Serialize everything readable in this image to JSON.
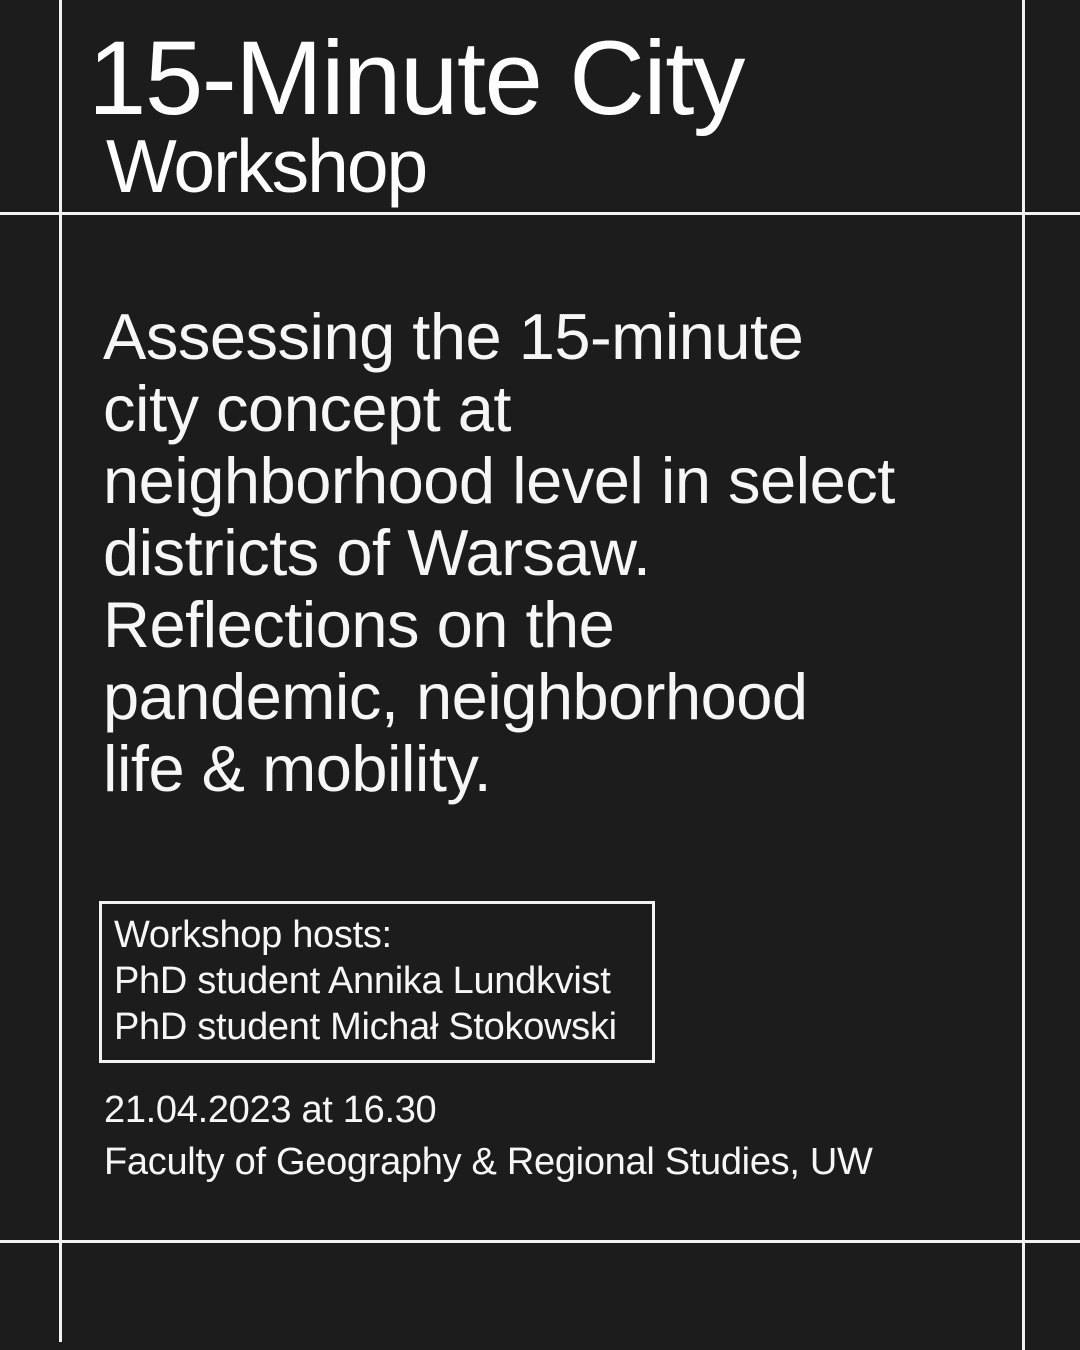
{
  "poster": {
    "title": "15-Minute City",
    "subtitle": "Workshop",
    "description": "Assessing the 15-minute\ncity concept at\nneighborhood level in select\ndistricts of Warsaw.\nReflections on the\npandemic, neighborhood\nlife & mobility.",
    "hosts_box": {
      "heading": "Workshop hosts:",
      "hosts": [
        "PhD student Annika Lundkvist",
        "PhD student Michał Stokowski"
      ]
    },
    "event": {
      "datetime": "21.04.2023 at 16.30",
      "location": "Faculty of Geography & Regional Studies, UW"
    },
    "colors": {
      "background": "#1c1c1c",
      "foreground": "#fafafa",
      "frame_line": "#f2f2f2"
    }
  }
}
